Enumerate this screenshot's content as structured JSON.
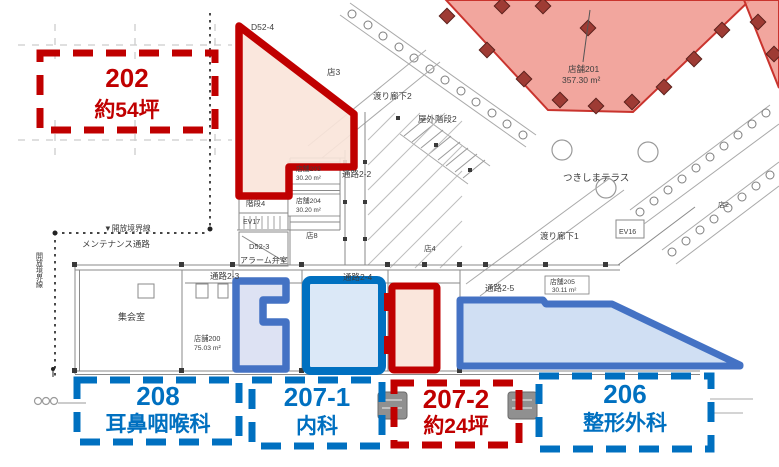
{
  "callouts": {
    "unit202": {
      "code": "202",
      "detail": "約54坪"
    },
    "unit208": {
      "code": "208",
      "detail": "耳鼻咽喉科"
    },
    "unit207_1": {
      "code": "207-1",
      "detail": "内科"
    },
    "unit207_2": {
      "code": "207-2",
      "detail": "約24坪"
    },
    "unit206": {
      "code": "206",
      "detail": "整形外科"
    }
  },
  "plan": {
    "labels": [
      {
        "text": "D52-4"
      },
      {
        "text": "店3"
      },
      {
        "text": "渡り廊下2"
      },
      {
        "text": "屋外階段2"
      },
      {
        "text": "店舗203"
      },
      {
        "text": "30.20 m²"
      },
      {
        "text": "通路2-2"
      },
      {
        "text": "店舗204"
      },
      {
        "text": "30.20 m²"
      },
      {
        "text": "階段4"
      },
      {
        "text": "EV17"
      },
      {
        "text": "D52-3"
      },
      {
        "text": "アラーム弁室"
      },
      {
        "text": "店8"
      },
      {
        "text": "店4"
      },
      {
        "text": "通路2-3"
      },
      {
        "text": "通路2-4"
      },
      {
        "text": "通路2-5"
      },
      {
        "text": "店舗205"
      },
      {
        "text": "30.11 m²"
      },
      {
        "text": "店舗200"
      },
      {
        "text": "75.03 m²"
      },
      {
        "text": "集会室"
      },
      {
        "text": "店舗201"
      },
      {
        "text": "357.30 m²"
      },
      {
        "text": "つきしまテラス"
      },
      {
        "text": "渡り廊下1"
      },
      {
        "text": "EV16"
      },
      {
        "text": "メンテナンス通路"
      },
      {
        "text": "▼開放境界線"
      },
      {
        "text": "開放境界線"
      },
      {
        "text": "000"
      },
      {
        "text": "店2"
      }
    ]
  },
  "colors": {
    "annotation_red": "#C00000",
    "annotation_blue": "#0070C0",
    "shape_blue_muted": "#4472C4",
    "highlight_peach": "#FAE4D9",
    "highlight_blue_light": "#D8E6F6",
    "highlight_lavender": "#DADFF2",
    "store201_pink": "#F19C94",
    "plan_line_gray": "#8A8A8A"
  }
}
